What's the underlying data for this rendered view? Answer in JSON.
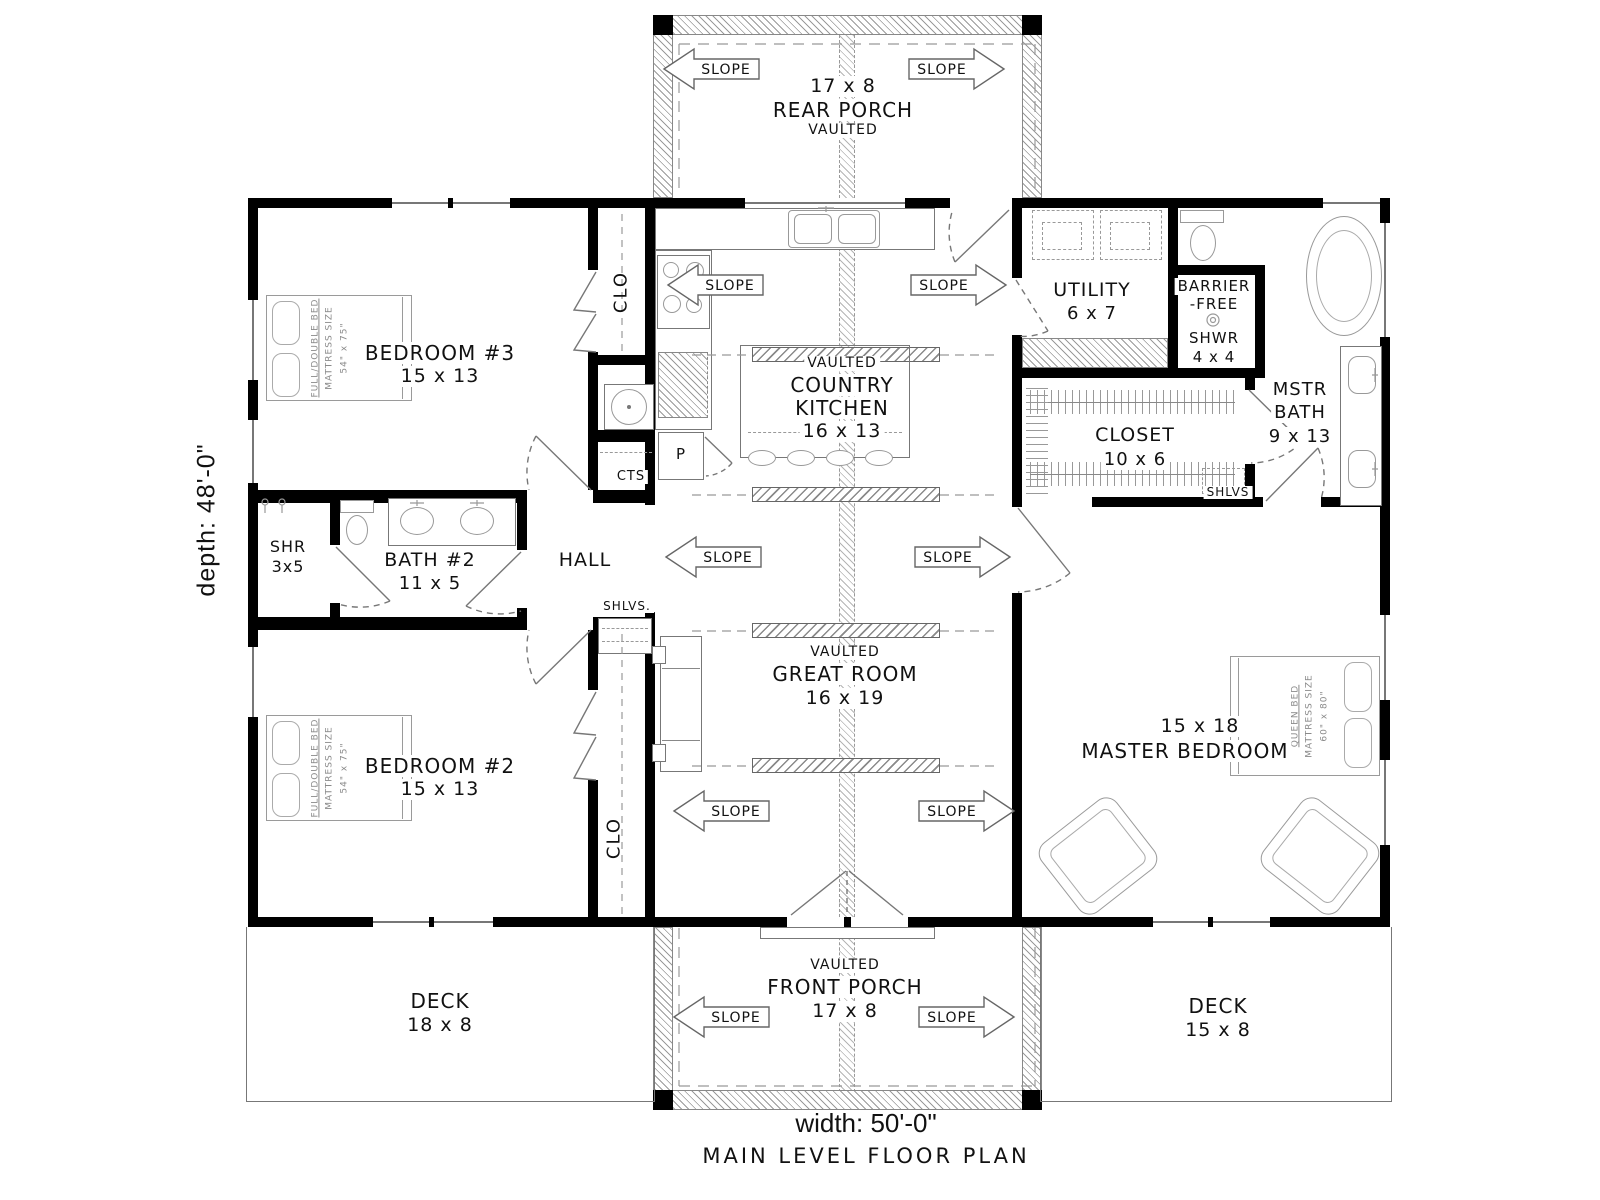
{
  "labels": {
    "slope": "SLOPE"
  },
  "titles": {
    "width_label": "width: 50'-0\"",
    "depth_label": "depth: 48'-0\"",
    "plan_title": "MAIN LEVEL FLOOR PLAN"
  },
  "rooms": {
    "rear_porch": {
      "dims": "17 x 8",
      "name": "REAR PORCH",
      "vaulted": "VAULTED"
    },
    "bedroom3": {
      "name": "BEDROOM #3",
      "dims": "15 x 13"
    },
    "kitchen": {
      "vaulted": "VAULTED",
      "line1": "COUNTRY",
      "line2": "KITCHEN",
      "dims": "16 x 13"
    },
    "utility": {
      "name": "UTILITY",
      "dims": "6 x 7"
    },
    "barrier_shwr": {
      "line1": "BARRIER",
      "line2": "-FREE",
      "line3": "SHWR",
      "line4": "4 x 4"
    },
    "mstr_bath": {
      "line1": "MSTR",
      "line2": "BATH",
      "dims": "9 x 13"
    },
    "master_closet": {
      "name": "CLOSET",
      "dims": "10 x 6",
      "shelves": "SHLVS"
    },
    "shr": {
      "name": "SHR",
      "dims": "3x5"
    },
    "bath2": {
      "name": "BATH #2",
      "dims": "11 x 5"
    },
    "hall": {
      "name": "HALL",
      "shelves": "SHLVS."
    },
    "great_room": {
      "vaulted": "VAULTED",
      "name": "GREAT ROOM",
      "dims": "16 x 19"
    },
    "bedroom2": {
      "name": "BEDROOM #2",
      "dims": "15 x 13"
    },
    "master_bedroom": {
      "dims": "15 x 18",
      "name": "MASTER BEDROOM"
    },
    "front_porch": {
      "vaulted": "VAULTED",
      "name": "FRONT PORCH",
      "dims": "17 x 8"
    },
    "deck_left": {
      "name": "DECK",
      "dims": "18 x 8"
    },
    "deck_right": {
      "name": "DECK",
      "dims": "15 x 8"
    }
  },
  "closets": {
    "clo": "CLO",
    "cts": "CTS",
    "pantry": "P"
  },
  "furniture": {
    "full_bed_l1": "FULL/DOUBLE BED",
    "full_bed_l2": "MATTRESS SIZE",
    "full_bed_l3": "54\" x 75\"",
    "queen_l1": "QUEEN BED",
    "queen_l2": "MATTRESS SIZE",
    "queen_l3": "60\" x 80\""
  }
}
